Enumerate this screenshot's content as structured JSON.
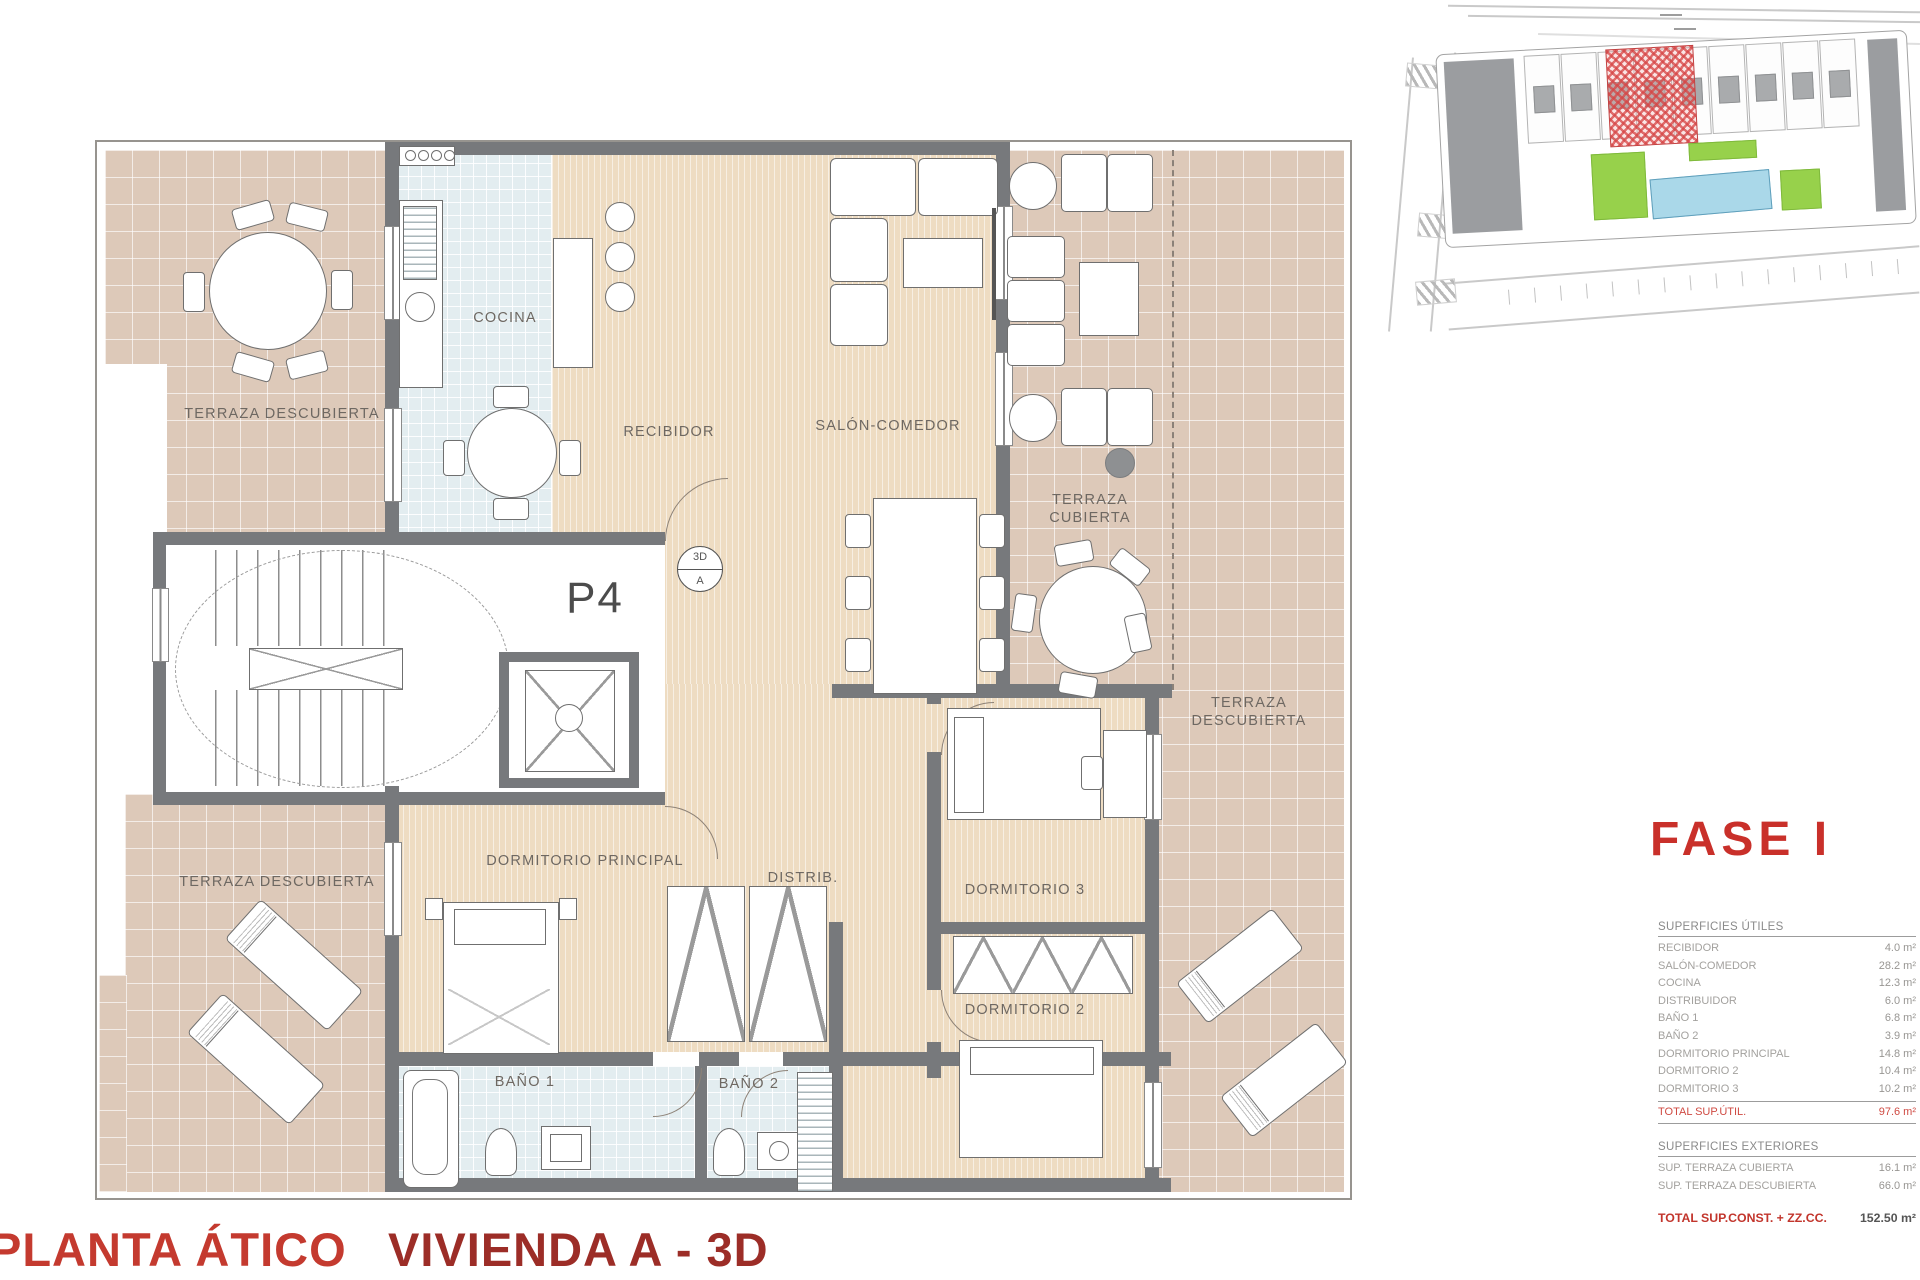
{
  "phase_label": "FASE I",
  "footer": {
    "left_title": "PLANTA ÁTICO",
    "right_title": "VIVIENDA A - 3D"
  },
  "plan": {
    "unit_label": "P4",
    "section_marker": {
      "top": "3D",
      "bottom": "A"
    },
    "labels": {
      "terraza_tl": "TERRAZA DESCUBIERTA",
      "cocina": "COCINA",
      "recibidor": "RECIBIDOR",
      "salon": "SALÓN-COMEDOR",
      "terraza_cubierta": "TERRAZA\nCUBIERTA",
      "terraza_right": "TERRAZA\nDESCUBIERTA",
      "dormitorio_principal": "DORMITORIO PRINCIPAL",
      "distrib": "DISTRIB.",
      "dormitorio3": "DORMITORIO 3",
      "dormitorio2": "DORMITORIO 2",
      "bano1": "BAÑO 1",
      "bano2": "BAÑO 2",
      "terraza_bl": "TERRAZA DESCUBIERTA"
    }
  },
  "surface_tables": {
    "utiles": {
      "header": "SUPERFICIES ÚTILES",
      "rows": [
        [
          "RECIBIDOR",
          "4.0 m²"
        ],
        [
          "SALÓN-COMEDOR",
          "28.2 m²"
        ],
        [
          "COCINA",
          "12.3 m²"
        ],
        [
          "DISTRIBUIDOR",
          "6.0 m²"
        ],
        [
          "BAÑO 1",
          "6.8 m²"
        ],
        [
          "BAÑO 2",
          "3.9 m²"
        ],
        [
          "DORMITORIO PRINCIPAL",
          "14.8 m²"
        ],
        [
          "DORMITORIO 2",
          "10.4 m²"
        ],
        [
          "DORMITORIO 3",
          "10.2 m²"
        ]
      ],
      "total": {
        "label": "TOTAL SUP.ÚTIL.",
        "value": "97.6 m²"
      }
    },
    "exteriores": {
      "header": "SUPERFICIES EXTERIORES",
      "rows": [
        [
          "SUP. TERRAZA CUBIERTA",
          "16.1 m²"
        ],
        [
          "SUP. TERRAZA DESCUBIERTA",
          "66.0 m²"
        ]
      ]
    },
    "grand_total": {
      "label": "TOTAL SUP.CONST. + ZZ.CC.",
      "value": "152.50 m²"
    }
  },
  "colors": {
    "accent_red": "#c9302a",
    "highlight_unit_red": "#d64444",
    "pool_blue": "#aad8e9",
    "grass_green": "#97d14b",
    "wall_gray": "#77797c"
  }
}
